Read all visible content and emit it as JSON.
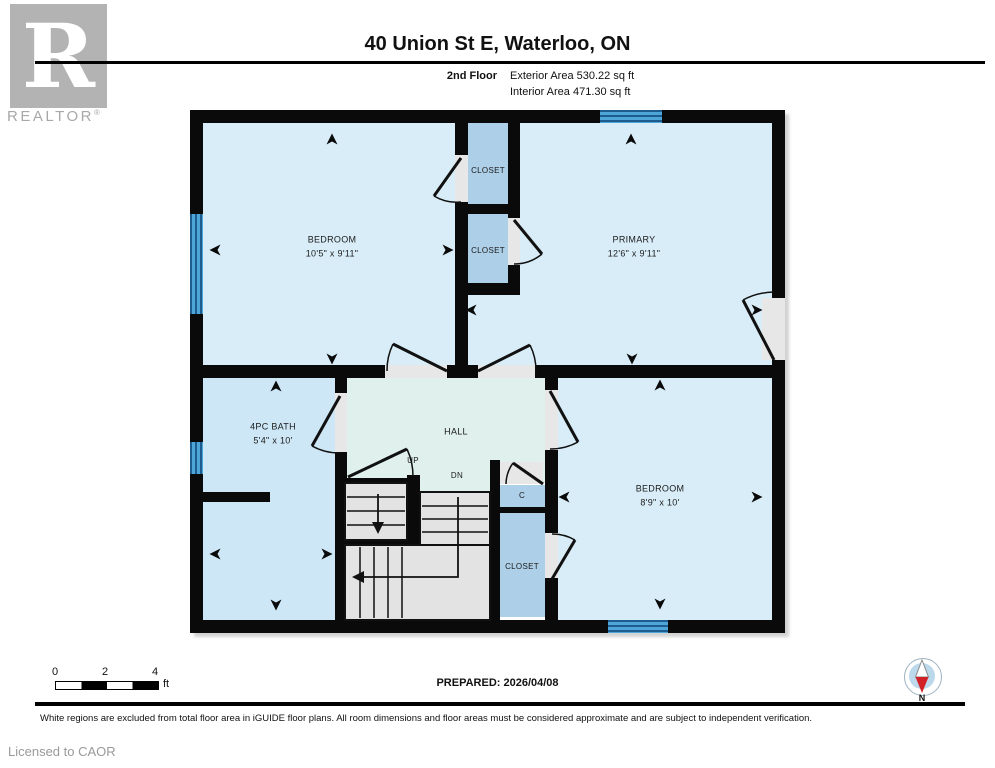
{
  "header": {
    "logo": {
      "letter": "R",
      "brand": "REALTOR",
      "registered": "®"
    },
    "title": "40 Union St E, Waterloo, ON",
    "floor_label": "2nd Floor",
    "exterior_area": "Exterior Area 530.22 sq ft",
    "interior_area": "Interior Area 471.30 sq ft"
  },
  "plan": {
    "rooms": {
      "bedroom1": {
        "name": "BEDROOM",
        "dims": "10'5\" x 9'11\""
      },
      "primary": {
        "name": "PRIMARY",
        "dims": "12'6\" x 9'11\""
      },
      "closet_top": {
        "name": "CLOSET"
      },
      "closet_mid": {
        "name": "CLOSET"
      },
      "bath": {
        "name": "4PC BATH",
        "dims": "5'4\" x 10'"
      },
      "hall": {
        "name": "HALL"
      },
      "up_label": "UP",
      "dn_label": "DN",
      "closet_c": {
        "name": "C"
      },
      "closet_br": {
        "name": "CLOSET"
      },
      "bedroom2": {
        "name": "BEDROOM",
        "dims": "8'9\" x 10'"
      }
    }
  },
  "footer": {
    "scale": {
      "t0": "0",
      "t2": "2",
      "t4": "4",
      "unit": "ft"
    },
    "prepared": "PREPARED: 2026/04/08",
    "disclaimer": "White regions are excluded from total floor area in iGUIDE floor plans. All room dimensions and floor areas must be considered approximate and are subject to independent verification.",
    "licensed": "Licensed to CAOR",
    "compass_n": "N"
  },
  "colors": {
    "room_fill": "#d9edf8",
    "bath_fill": "#cde7f6",
    "hall_fill": "#dff0ed",
    "closet_fill": "#adcfe8",
    "window_blue": "#4da5d8",
    "window_line": "#1c5c8e",
    "stair_gray": "#e3e3e3",
    "opening_gray": "#e7e7e7",
    "wall_black": "#0a0a0a",
    "compass_red": "#d22027",
    "logo_gray": "#b3b3b3"
  }
}
